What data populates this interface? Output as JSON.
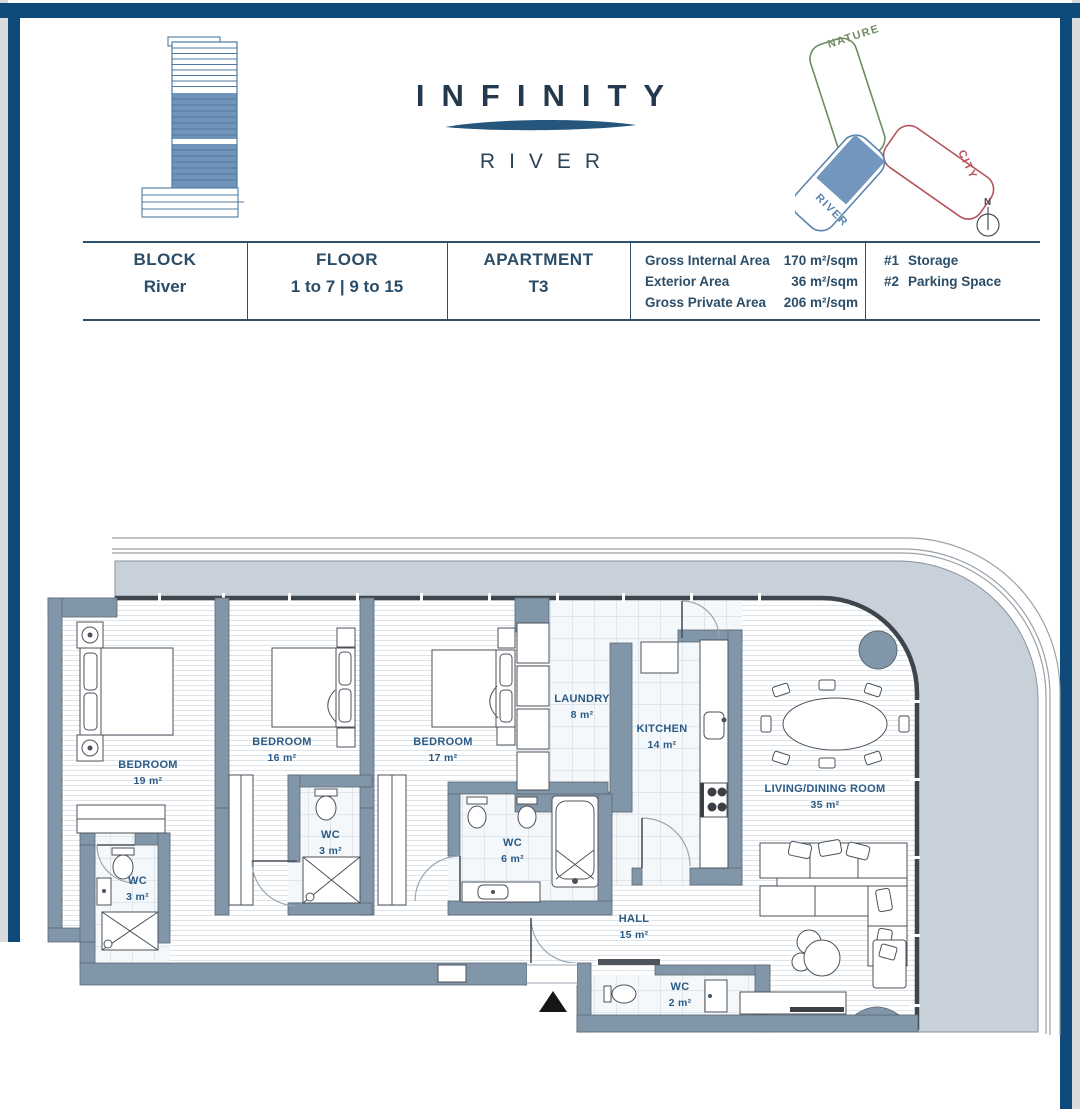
{
  "brand": {
    "title": "INFINITY",
    "subtitle": "RIVER"
  },
  "keyplan": {
    "nature": "NATURE",
    "city": "CITY",
    "river": "RIVER",
    "compass_n": "N",
    "colors": {
      "nature": "#6f8b63",
      "city": "#b5535b",
      "river": "#5b84ad",
      "unit_fill": "#7296bd"
    }
  },
  "info_table": {
    "block": {
      "label": "BLOCK",
      "value": "River"
    },
    "floor": {
      "label": "FLOOR",
      "value": "1 to 7 | 9 to 15"
    },
    "apartment": {
      "label": "APARTMENT",
      "value": "T3"
    },
    "areas": [
      {
        "label": "Gross Internal Area",
        "value": "170 m²/sqm"
      },
      {
        "label": "Exterior Area",
        "value": "36 m²/sqm"
      },
      {
        "label": "Gross Private Area",
        "value": "206 m²/sqm"
      }
    ],
    "extras": [
      {
        "num": "#1",
        "text": "Storage"
      },
      {
        "num": "#2",
        "text": "Parking Space"
      }
    ]
  },
  "floorplan": {
    "colors": {
      "wall": "#8296a9",
      "terrace": "#c8d1da",
      "label": "#2a5a85"
    },
    "rooms": [
      {
        "name": "BEDROOM",
        "area": "19 m²"
      },
      {
        "name": "BEDROOM",
        "area": "16 m²"
      },
      {
        "name": "BEDROOM",
        "area": "17 m²"
      },
      {
        "name": "LAUNDRY",
        "area": "8 m²"
      },
      {
        "name": "KITCHEN",
        "area": "14 m²"
      },
      {
        "name": "LIVING/DINING ROOM",
        "area": "35 m²"
      },
      {
        "name": "WC",
        "area": "3 m²"
      },
      {
        "name": "WC",
        "area": "3 m²"
      },
      {
        "name": "WC",
        "area": "6 m²"
      },
      {
        "name": "HALL",
        "area": "15 m²"
      },
      {
        "name": "WC",
        "area": "2 m²"
      }
    ]
  }
}
